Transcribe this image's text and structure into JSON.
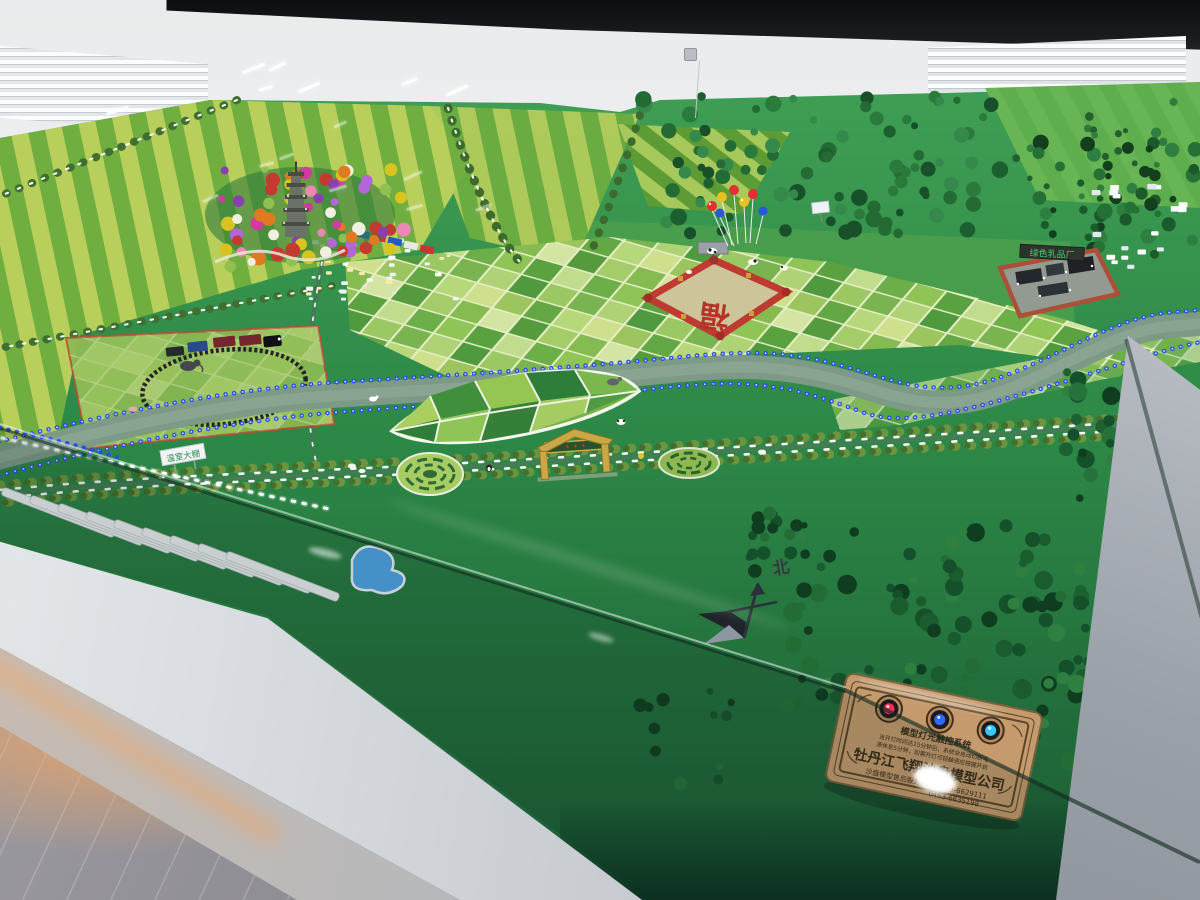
{
  "palette": {
    "wall": "#eef0f1",
    "screen": "#141619",
    "turf": "#2c8746",
    "turf-dark": "#1b5a34",
    "field-light": "#b9cf5b",
    "field-mid": "#6fae3f",
    "river": "#7c9a86",
    "led-blue": "#2b4cf0",
    "led-white": "#ffffff",
    "forest-dark": "#14512a",
    "fortune-red": "#b5342a",
    "plaque-bronze": "#c59b6e",
    "under-glow": "#f0a868",
    "glass-tint": "#12352a"
  },
  "signs": {
    "dairy_factory": "绿色乳品厂",
    "greenhouse": "温室大棚",
    "compass_north": "北",
    "fortune_char": "福"
  },
  "plaque": {
    "title": "模型灯光触控系统",
    "note_line1": "当开灯时间达15分钟后，系统会自动切断电",
    "note_line2": "源休息5分钟，如需开灯可轻触感应按键开启",
    "company": "牡丹江飞翔沙盘模型公司",
    "hotline": "沙盘模型售后服务热线:0453-6629111",
    "hotline2": "0453-6635198",
    "buttons": [
      {
        "name": "power-led-red",
        "color": "#ff2d55"
      },
      {
        "name": "power-led-blue",
        "color": "#2f6bff"
      },
      {
        "name": "power-led-cyan",
        "color": "#35c8ff"
      }
    ]
  }
}
